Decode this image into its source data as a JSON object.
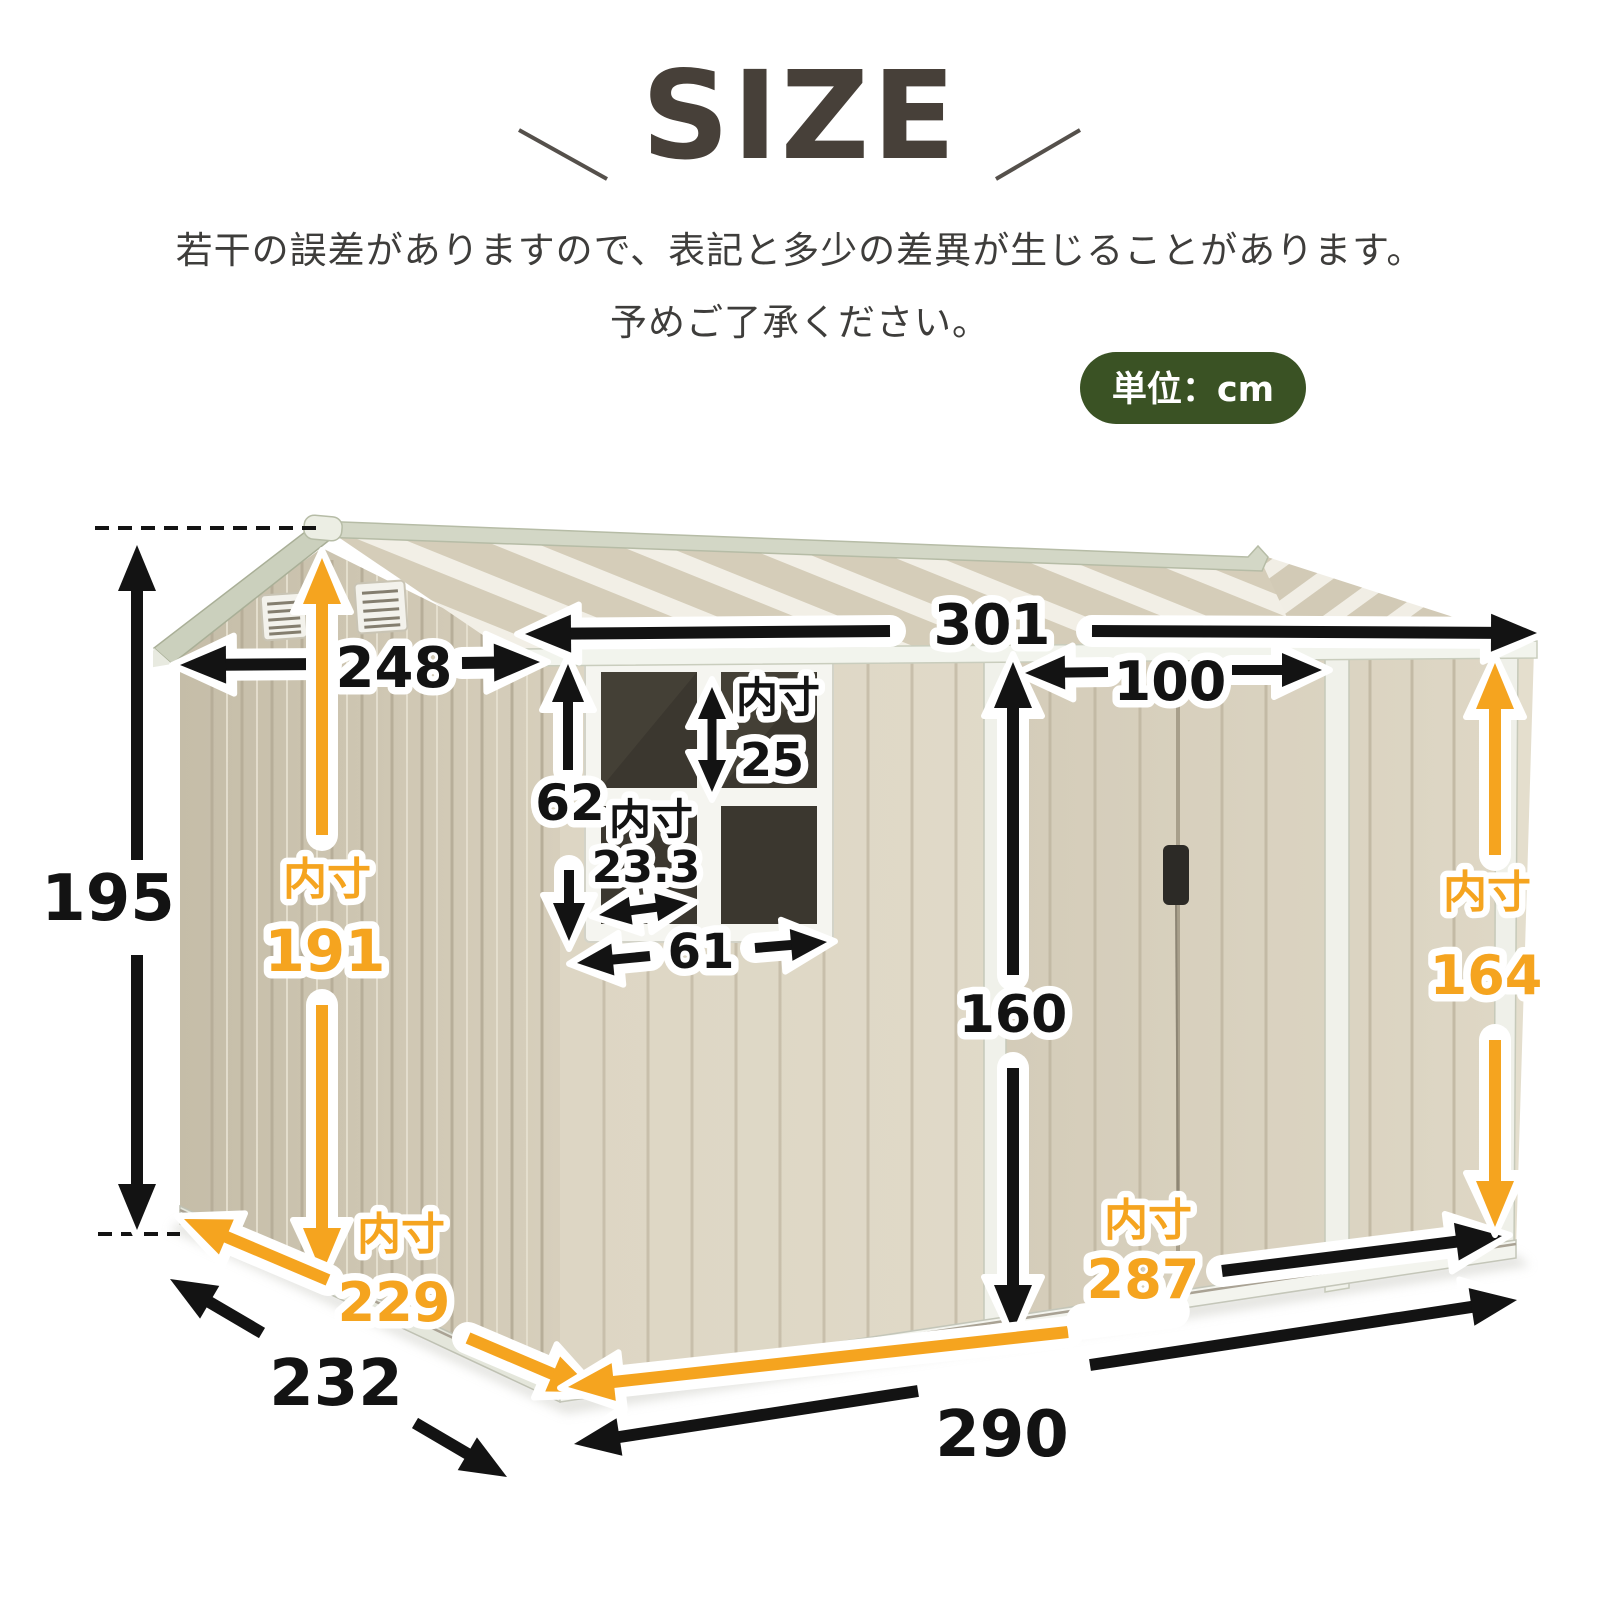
{
  "header": {
    "title": "SIZE",
    "note_line1": "若干の誤差がありますので、表記と多少の差異が生じることがあります。",
    "note_line2": "予めご了承ください。",
    "unit_badge": "単位：cm"
  },
  "colors": {
    "accent_orange": "#F5A41F",
    "badge_green": "#3A5224",
    "dimension_black": "#131313"
  },
  "shed": {
    "inner_label": "内寸"
  },
  "dimensions": {
    "outer_height": "195",
    "inner_height": "191",
    "roof_depth": "248",
    "roof_width": "301",
    "door_width": "100",
    "window_height": "62",
    "window_pane_height": "25",
    "window_pane_width": "23.3",
    "window_width": "61",
    "door_height": "160",
    "inner_height_right": "164",
    "inner_width": "287",
    "outer_width": "290",
    "outer_depth": "232",
    "inner_depth": "229"
  }
}
